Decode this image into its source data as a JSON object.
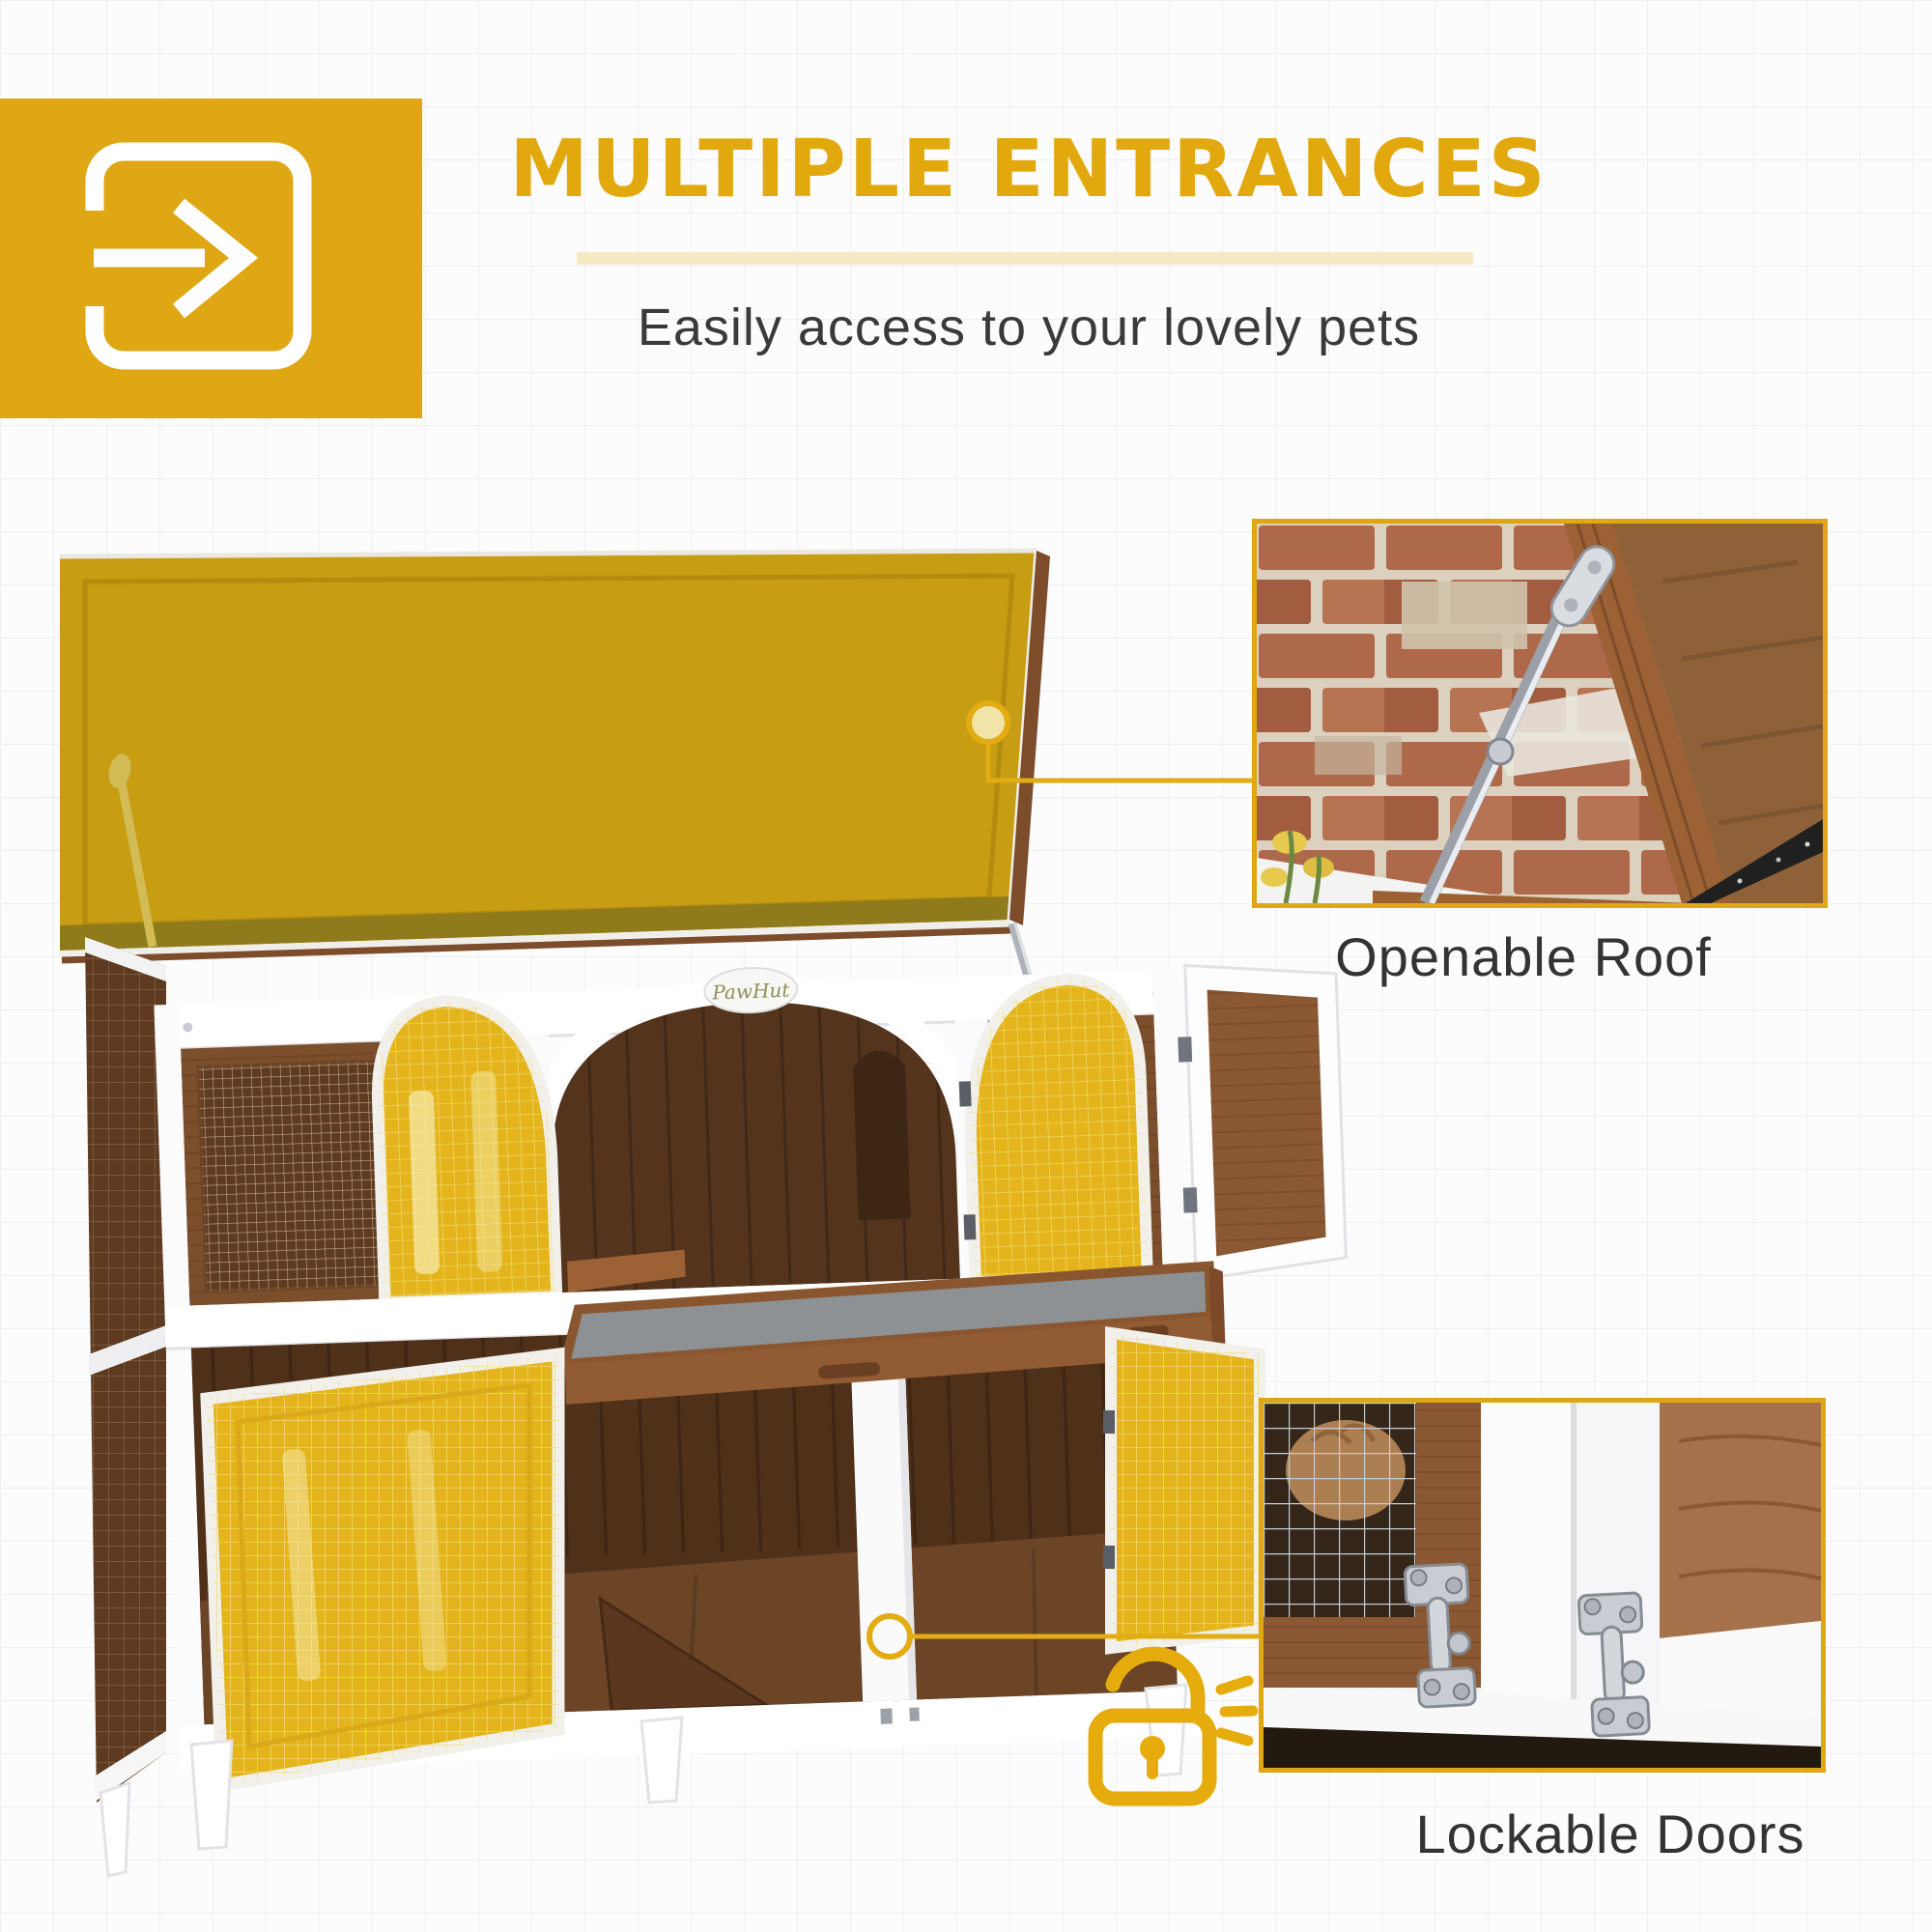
{
  "header": {
    "title": "MULTIPLE ENTRANCES",
    "subtitle": "Easily access to your lovely pets",
    "icon": "enter-arrow-icon"
  },
  "brand": {
    "logo_text": "PawHut"
  },
  "features": [
    {
      "label": "Openable Roof",
      "marker": "circle-marker-on-roof",
      "photo": "openable-roof-closeup"
    },
    {
      "label": "Lockable Doors",
      "marker": "circle-marker-on-latch",
      "photo": "door-latches-closeup",
      "icon": "open-padlock-icon"
    }
  ],
  "colors": {
    "accent": "#DFA713",
    "accent_pale": "#F6E9C4",
    "heading": "#E2A90F",
    "roof_highlight": "#C69D13",
    "door_highlight": "#E3B41B",
    "text": "#3A3A3A",
    "wood": "#7B4E2C",
    "wood_dark": "#54341D",
    "frame": "#FFFFFF"
  }
}
